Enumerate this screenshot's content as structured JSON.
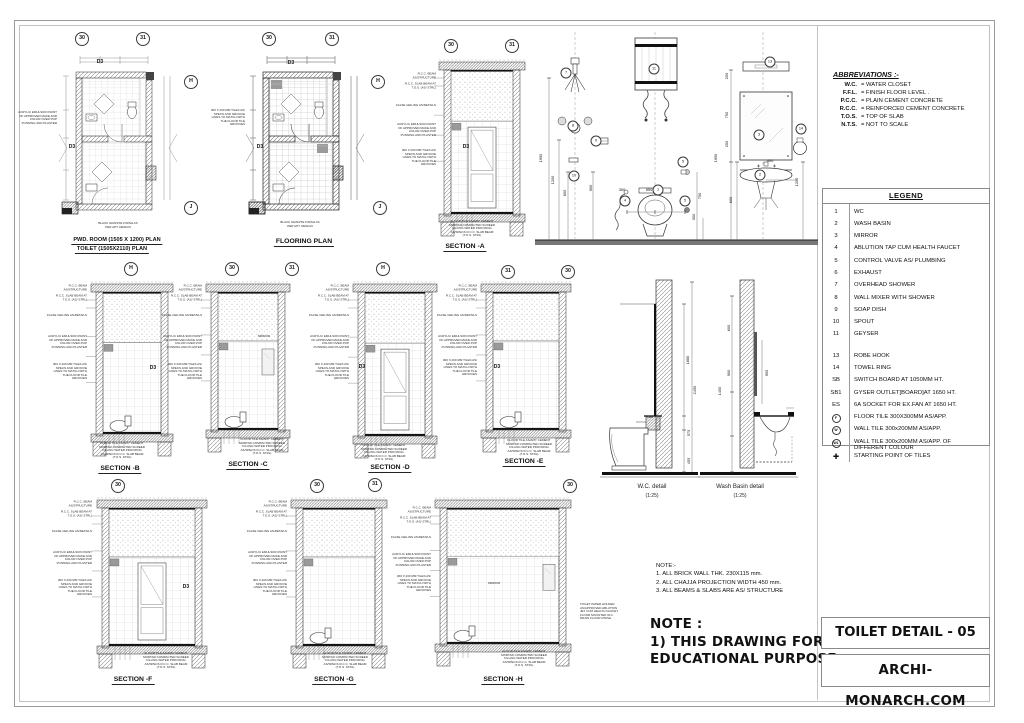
{
  "sheet": {
    "title": "TOILET DETAIL - 05",
    "website": "ARCHI-MONARCH.COM"
  },
  "abbreviations": {
    "heading": "ABBREVIATIONS :-",
    "items": [
      {
        "abbr": "W.C.",
        "full": "=  WATER CLOSET"
      },
      {
        "abbr": "F.F.L.",
        "full": "=  FINISH FLOOR LEVEL ."
      },
      {
        "abbr": "P.C.C.",
        "full": "=  PLAIN CEMENT CONCRETE"
      },
      {
        "abbr": "R.C.C.",
        "full": "=  REINFORCED CEMENT CONCRETE"
      },
      {
        "abbr": "T.O.S.",
        "full": "=  TOP OF SLAB"
      },
      {
        "abbr": "N.T.S.",
        "full": "=  NOT TO SCALE"
      }
    ]
  },
  "legend": {
    "heading": "LEGEND",
    "items": [
      {
        "key": "1",
        "label": "WC"
      },
      {
        "key": "2",
        "label": "WASH BASIN"
      },
      {
        "key": "3",
        "label": "MIRROR"
      },
      {
        "key": "4",
        "label": "ABLUTION TAP CUM HEALTH FAUCET"
      },
      {
        "key": "5",
        "label": "CONTROL VALVE AS/ PLUMBING"
      },
      {
        "key": "6",
        "label": "EXHAUST"
      },
      {
        "key": "7",
        "label": "OVERHEAD SHOWER"
      },
      {
        "key": "8",
        "label": "WALL MIXER WITH SHOWER"
      },
      {
        "key": "9",
        "label": "SOAP DISH"
      },
      {
        "key": "10",
        "label": "SPOUT"
      },
      {
        "key": "11",
        "label": "GEYSER"
      },
      {
        "key": "13",
        "label": "ROBE HOOK"
      },
      {
        "key": "14",
        "label": "TOWEL RING"
      },
      {
        "key": "SB",
        "label": "SWITCH BOARD AT 1050MM HT."
      },
      {
        "key": "SB1",
        "label": "GYSER OUTLET[BOARD]AT 1650 HT."
      },
      {
        "key": "ES",
        "label": "6A SOCKET FOR EX.FAN AT 1650 HT."
      },
      {
        "key": "F",
        "label": "FLOOR TILE 300X300MM AS/APP."
      },
      {
        "key": "W",
        "label": "WALL TILE 300x200MM AS/APP."
      },
      {
        "key": "W1",
        "label": "WALL TILE 300x200MM AS/APP. OF DIFFERENT COLOUR"
      },
      {
        "key": "✚",
        "label": "STARTING POINT OF TILES"
      }
    ]
  },
  "captions": {
    "plan1a": "PWD. ROOM (1505 X 1200) PLAN",
    "plan1b": "TOILET  (1505X2110) PLAN",
    "plan2": "FLOORING PLAN",
    "sectionA": "SECTION -A",
    "sectionB": "SECTION -B",
    "sectionC": "SECTION -C",
    "sectionD": "SECTION -D",
    "sectionE": "SECTION -E",
    "sectionF": "SECTION -F",
    "sectionG": "SECTION -G",
    "sectionH": "SECTION -H",
    "wc": "W.C. detail",
    "wcScale": "(1:25)",
    "basin": "Wash Basin detail",
    "basinScale": "(1:25)"
  },
  "grid": {
    "b30": "30",
    "b31": "31",
    "bH": "H",
    "bJ": "J",
    "d3": "D3"
  },
  "circles": {
    "c1": "1",
    "c2": "2",
    "c3": "3",
    "c4": "4",
    "c5": "5",
    "c7": "7",
    "c8": "8",
    "c9": "9",
    "c10": "10",
    "c11": "11",
    "c13": "13",
    "c14": "14"
  },
  "dims": {
    "d150": "150",
    "d200": "200",
    "d300": "300",
    "d400": "400",
    "d455": "455",
    "d550": "550",
    "d575": "575",
    "d600": "600",
    "d750": "750",
    "d800": "800",
    "d900": "900",
    "d950": "950",
    "d1200": "1200",
    "d1400": "1400",
    "d1680": "1680",
    "d1950": "1950",
    "d2450": "2450"
  },
  "annotations": {
    "rcc_beam": "R.C.C. BEAM AS/STRUCTURE",
    "rcc_slab": "R.C.C. SLAB BEAM AT T.O.S. (AS/ STRL)",
    "false_ceiling": "FALSE CEILING AS/DETAILS",
    "paint": "ACRYLIC EMULSION PAINT OF APPROVED MAKE AND COLOR OVER POP PUNNING AND PLASTER",
    "wall_tile": "300 X 200 MM TILES AS/ SPECS AND GROOVE LINES TO MATCH WITH THE FLOOR TILE GROOVES",
    "floor_stack": "FLOOR TILE AS/APP. CEMENT MORTAR COMPACTED SCREED FILLING WATER PROOFING AS/SPECS R.C.C. SLAB BEAM (T.O.S. STRL)",
    "wc_stack": "TOILET PAPER HOLDER AS/APPROVED ABLUTION JET CUM HEALTH FAUCET FLOOR MOUNTED W.C. DRAIN FLOOR FINISH",
    "granite": "BLACK GRANITE FINISH AS PER APT. DESIGN",
    "mirror": "MIRROR"
  },
  "notes_small": {
    "heading": "NOTE:-",
    "l1": "1. ALL BRICK WALL THK. 230X115 mm.",
    "l2": "2. ALL CHAJJA PROJECTION WIDTH 450 mm.",
    "l3": "3. ALL BEAMS & SLABS ARE AS/ STRUCTURE"
  },
  "note_big": {
    "l1": "NOTE :",
    "l2": "1) THIS DRAWING FOR",
    "l3": "EDUCATIONAL PURPOSE"
  }
}
